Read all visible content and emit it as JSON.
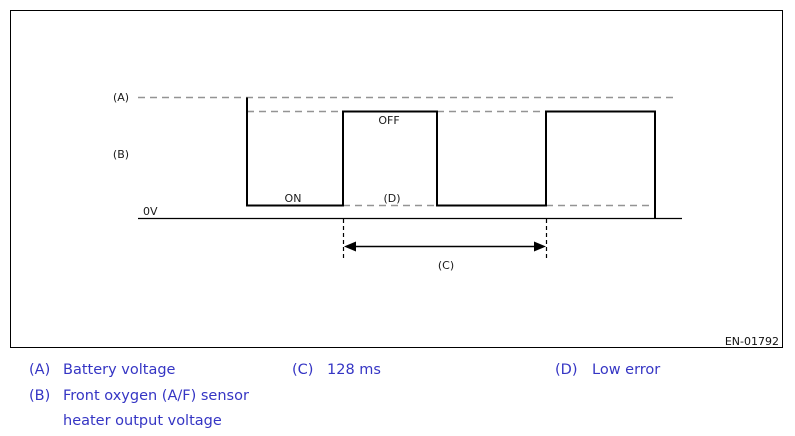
{
  "figure": {
    "code": "EN-01792"
  },
  "diagram": {
    "zero_volt_label": "0V",
    "marker_a": "(A)",
    "marker_b": "(B)",
    "marker_c": "(C)",
    "marker_d": "(D)",
    "state_on": "ON",
    "state_off": "OFF",
    "waveform": {
      "type": "square-wave",
      "signal": "Front oxygen (A/F) sensor heater output voltage",
      "state_sequence": [
        "ON",
        "OFF",
        "ON",
        "OFF"
      ],
      "high_reference_label": "(A)",
      "high_reference": "Battery voltage",
      "low_reference_label": "(D)",
      "low_reference": "Low error",
      "baseline_label": "0V",
      "period_label": "(C)",
      "period_ms": 128
    }
  },
  "legend": {
    "a_key": "(A)",
    "a_text": "Battery voltage",
    "b_key": "(B)",
    "b_text_line1": "Front oxygen (A/F) sensor",
    "b_text_line2": "heater output voltage",
    "c_key": "(C)",
    "c_text": "128 ms",
    "d_key": "(D)",
    "d_text": "Low error"
  },
  "colors": {
    "legend_text": "#3535c4",
    "diagram_line": "#000000",
    "diagram_text": "#1a1a1a",
    "reference_dash_gray": "#949494"
  }
}
